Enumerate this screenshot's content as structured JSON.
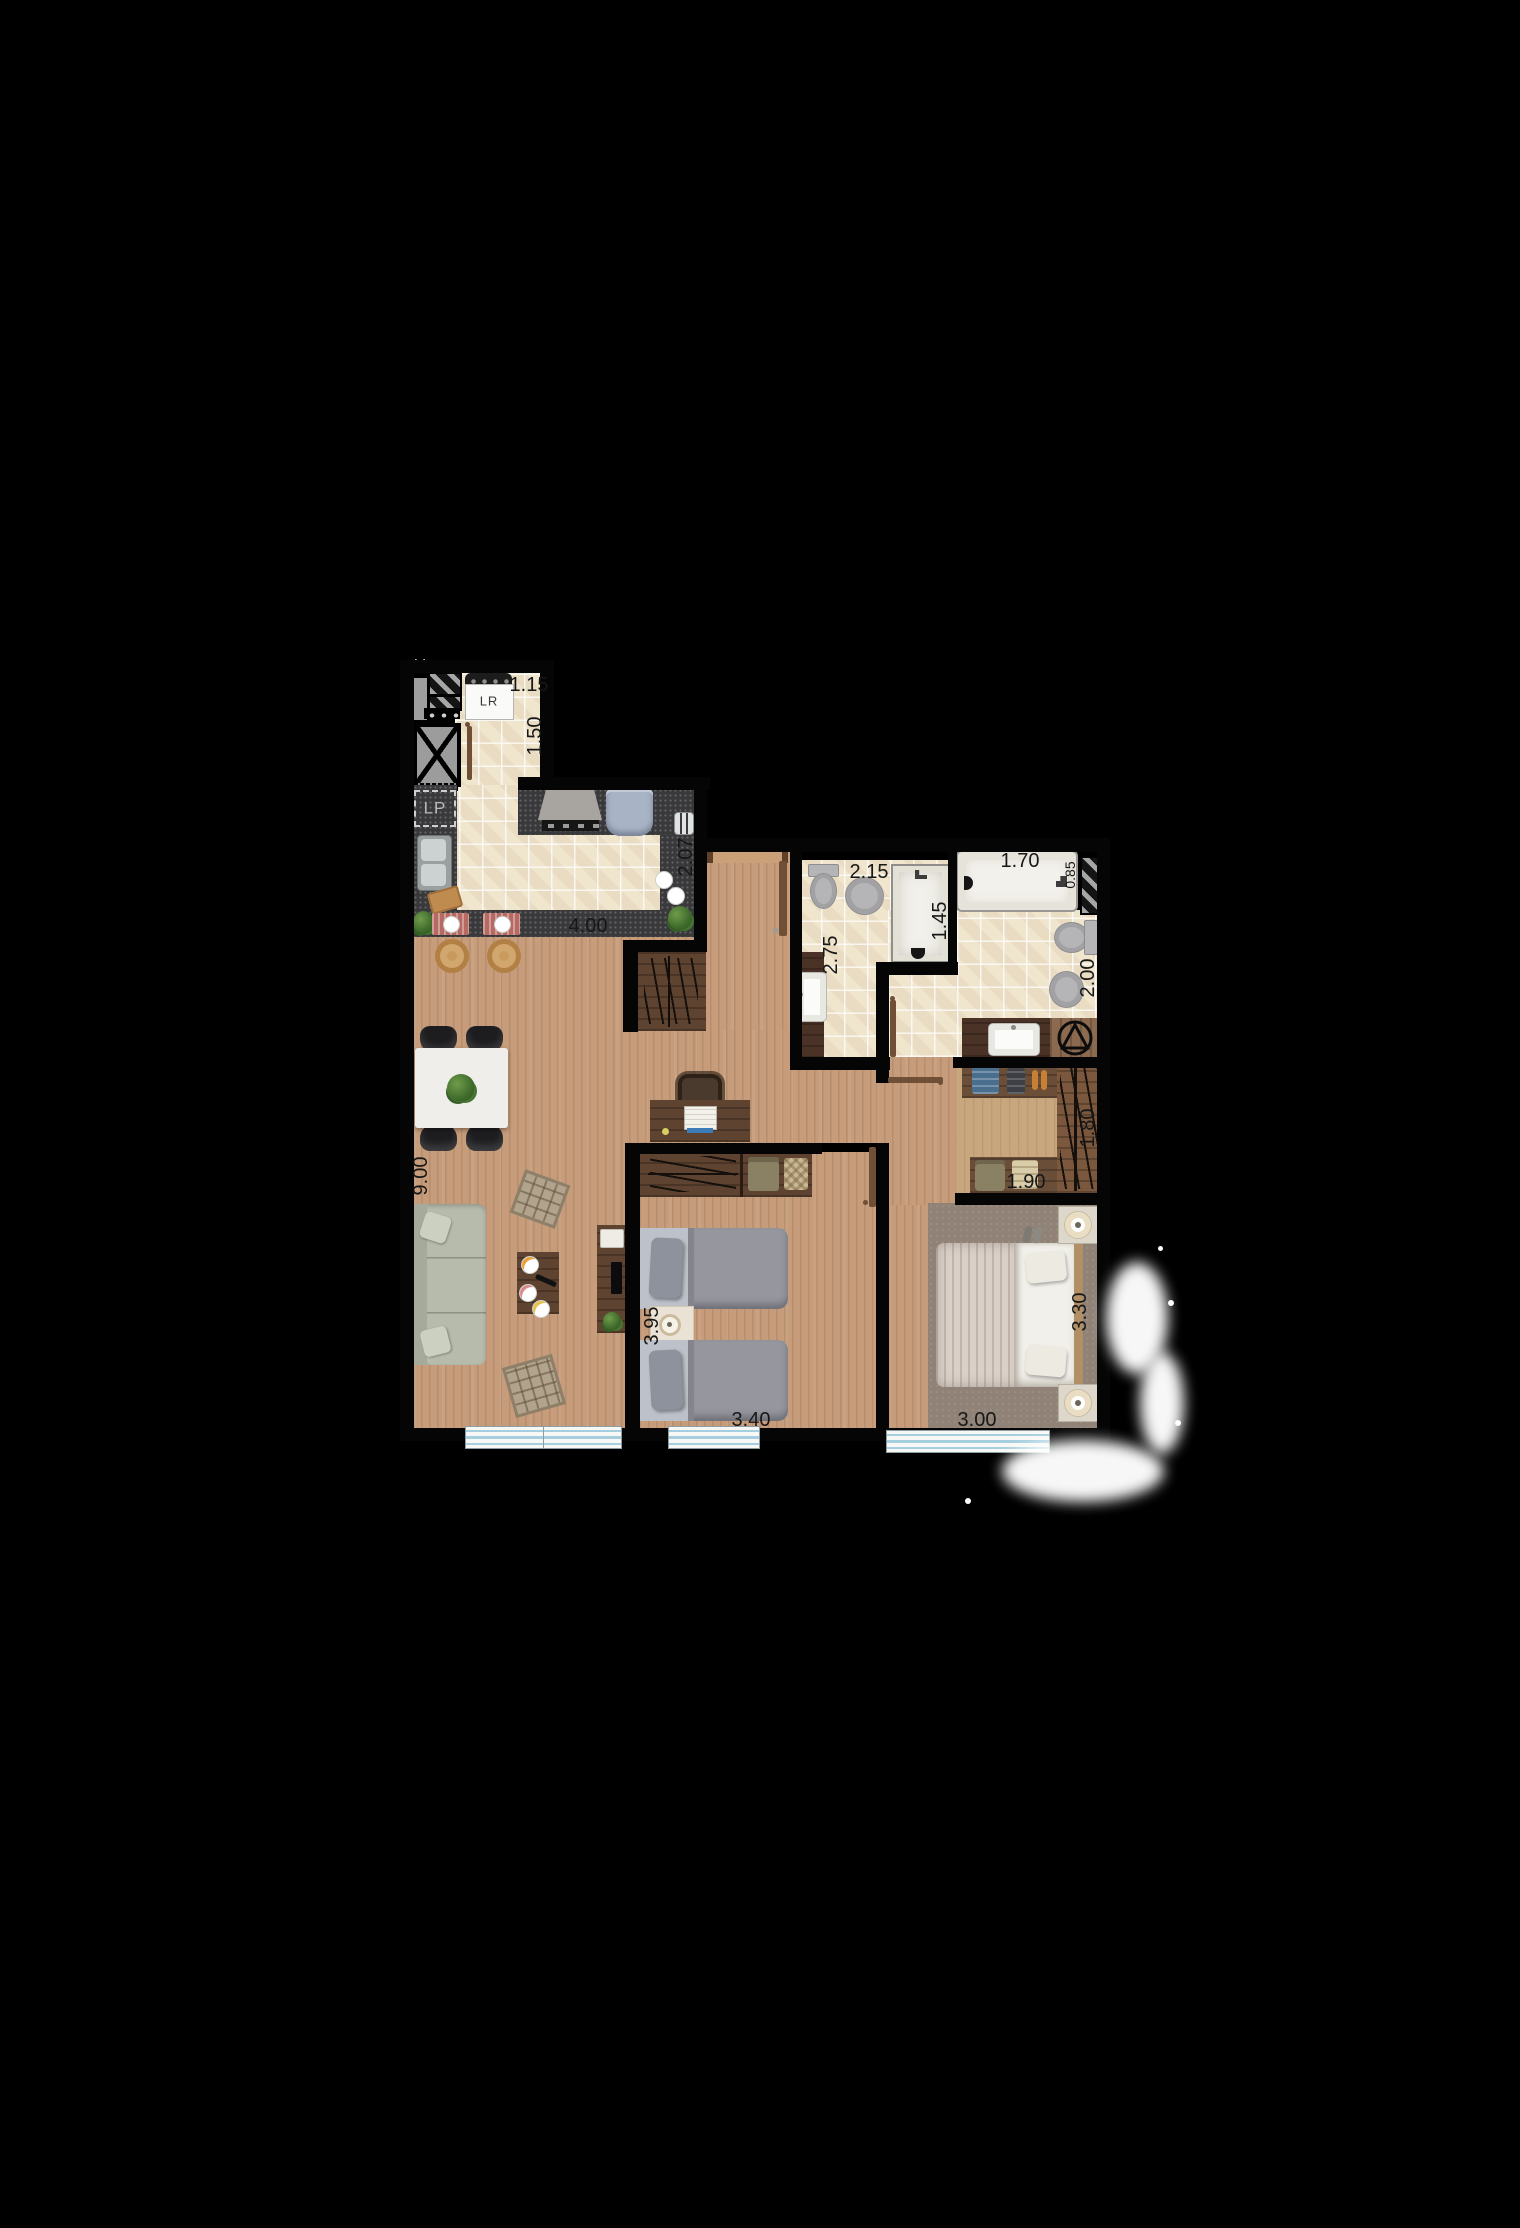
{
  "type": "apartment-floor-plan",
  "appliance_labels": {
    "washer": "LR",
    "dishwasher": "LP"
  },
  "dimensions_m": {
    "service_width": "1.15",
    "service_depth": "1.50",
    "kitchen_counter_depth": "2.07",
    "kitchen_width": "4.00",
    "bathroom1_width": "2.15",
    "bathroom1_shower_depth": "1.45",
    "bathroom1_depth": "2.75",
    "bathroom2_bathtub_length": "1.70",
    "bathroom2_bathtub_width": "0.85",
    "bathroom2_depth": "2.00",
    "closet_rail_depth": "1.80",
    "closet_shelf_width": "1.90",
    "living_total_depth": "9.00",
    "bedroom2_depth": "3.95",
    "bedroom2_width": "3.40",
    "bedroom1_width": "3.00",
    "bedroom1_depth": "3.30"
  },
  "colors": {
    "background": "#000000",
    "wood_floor": "#c69c7b",
    "tile_floor": "#f0e5cd",
    "counter_granite": "#39383b",
    "dimension_text": "#171717",
    "window_glass": "#a5cede"
  }
}
